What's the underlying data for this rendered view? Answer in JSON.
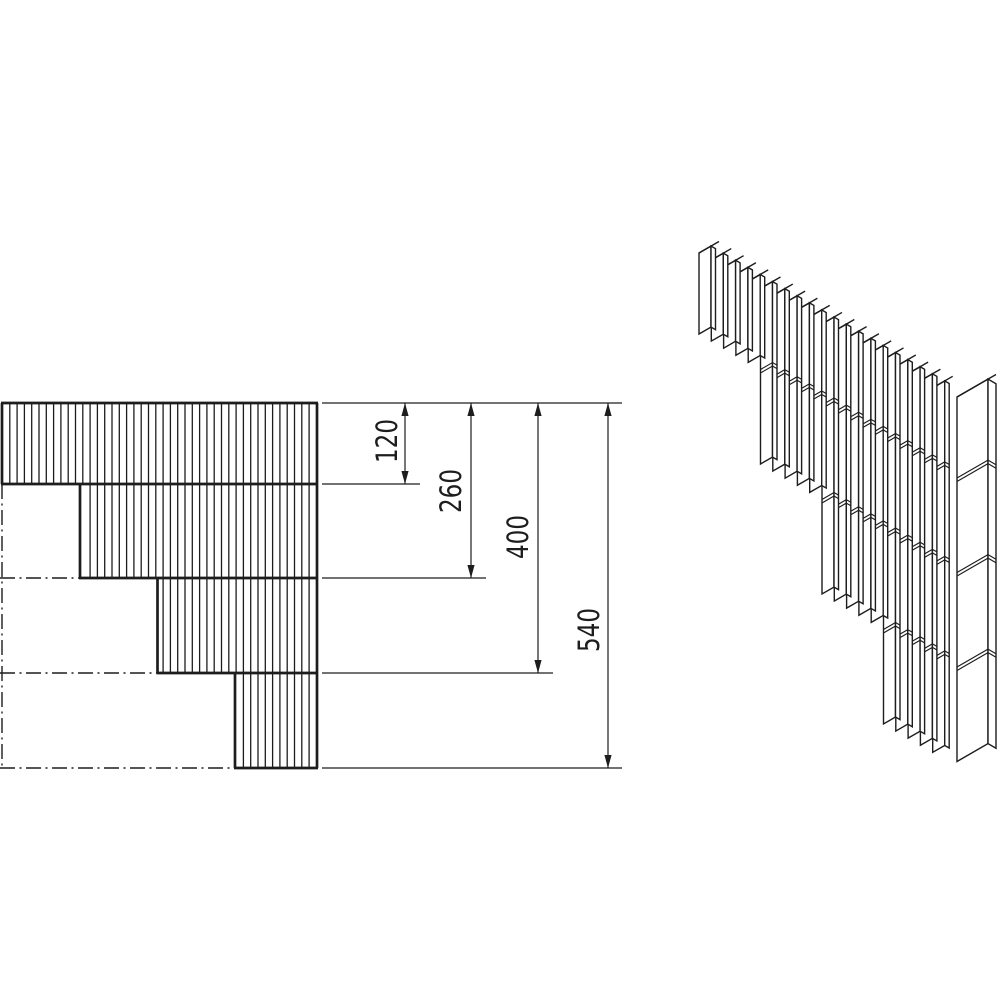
{
  "colors": {
    "background": "#ffffff",
    "line": "#1d1d1d"
  },
  "views": {
    "front": {
      "name": "stepped corner front elevation",
      "scale_px_per_unit": 0.675,
      "left_x": 2,
      "right_x": 317,
      "top_y": 403,
      "row_heights_units": [
        120,
        140,
        140,
        140
      ],
      "row_boundaries_y": [
        484,
        578,
        673,
        768
      ],
      "row_left_x": [
        2,
        80,
        157.5,
        235
      ],
      "hatch": {
        "start_x": 9.8,
        "spacing": 7.3
      },
      "centerline_vertical": {
        "x": 2,
        "from_y": 484,
        "to_y": 768
      },
      "centerlines_horizontal": [
        {
          "y": 578,
          "from_x": 0,
          "to_x": 80
        },
        {
          "y": 673,
          "from_x": 0,
          "to_x": 157.5
        },
        {
          "y": 768,
          "from_x": 0,
          "to_x": 235
        }
      ],
      "extension_lines": [
        {
          "y": 403,
          "from_x": 322,
          "to_x": 622
        },
        {
          "y": 484,
          "from_x": 322,
          "to_x": 420
        },
        {
          "y": 578,
          "from_x": 322,
          "to_x": 486
        },
        {
          "y": 673,
          "from_x": 322,
          "to_x": 553
        },
        {
          "y": 768,
          "from_x": 322,
          "to_x": 622
        }
      ],
      "dimensions": [
        {
          "label": "120",
          "value": 120,
          "line_x": 405,
          "to_y": 484,
          "label_x": 387,
          "label_y": 441
        },
        {
          "label": "260",
          "value": 260,
          "line_x": 471,
          "to_y": 578,
          "label_x": 451,
          "label_y": 491
        },
        {
          "label": "400",
          "value": 400,
          "line_x": 538,
          "to_y": 673,
          "label_x": 518,
          "label_y": 537
        },
        {
          "label": "540",
          "value": 540,
          "line_x": 608,
          "to_y": 768,
          "label_x": 589,
          "label_y": 630
        }
      ]
    },
    "iso": {
      "name": "isometric view of stepped slat corner",
      "slope": 0.577,
      "board_count": 20,
      "boards_per_group": 5,
      "first_board_x": 699,
      "first_board_y": 253,
      "pitch": 12.3,
      "board_depth_px": 12,
      "board_thickness_px": 4.5,
      "cap_offset": [
        8,
        -4.6
      ],
      "group_lengths_px": [
        81,
        175.5,
        270,
        364.5
      ],
      "joint_levels_px": [
        81,
        175.5,
        270
      ],
      "joint_gap_px": 3.5,
      "post": {
        "left_x": 957,
        "top_y": 397,
        "depth_px": 31,
        "thickness_px": 8,
        "length_px": 364.5
      }
    }
  }
}
